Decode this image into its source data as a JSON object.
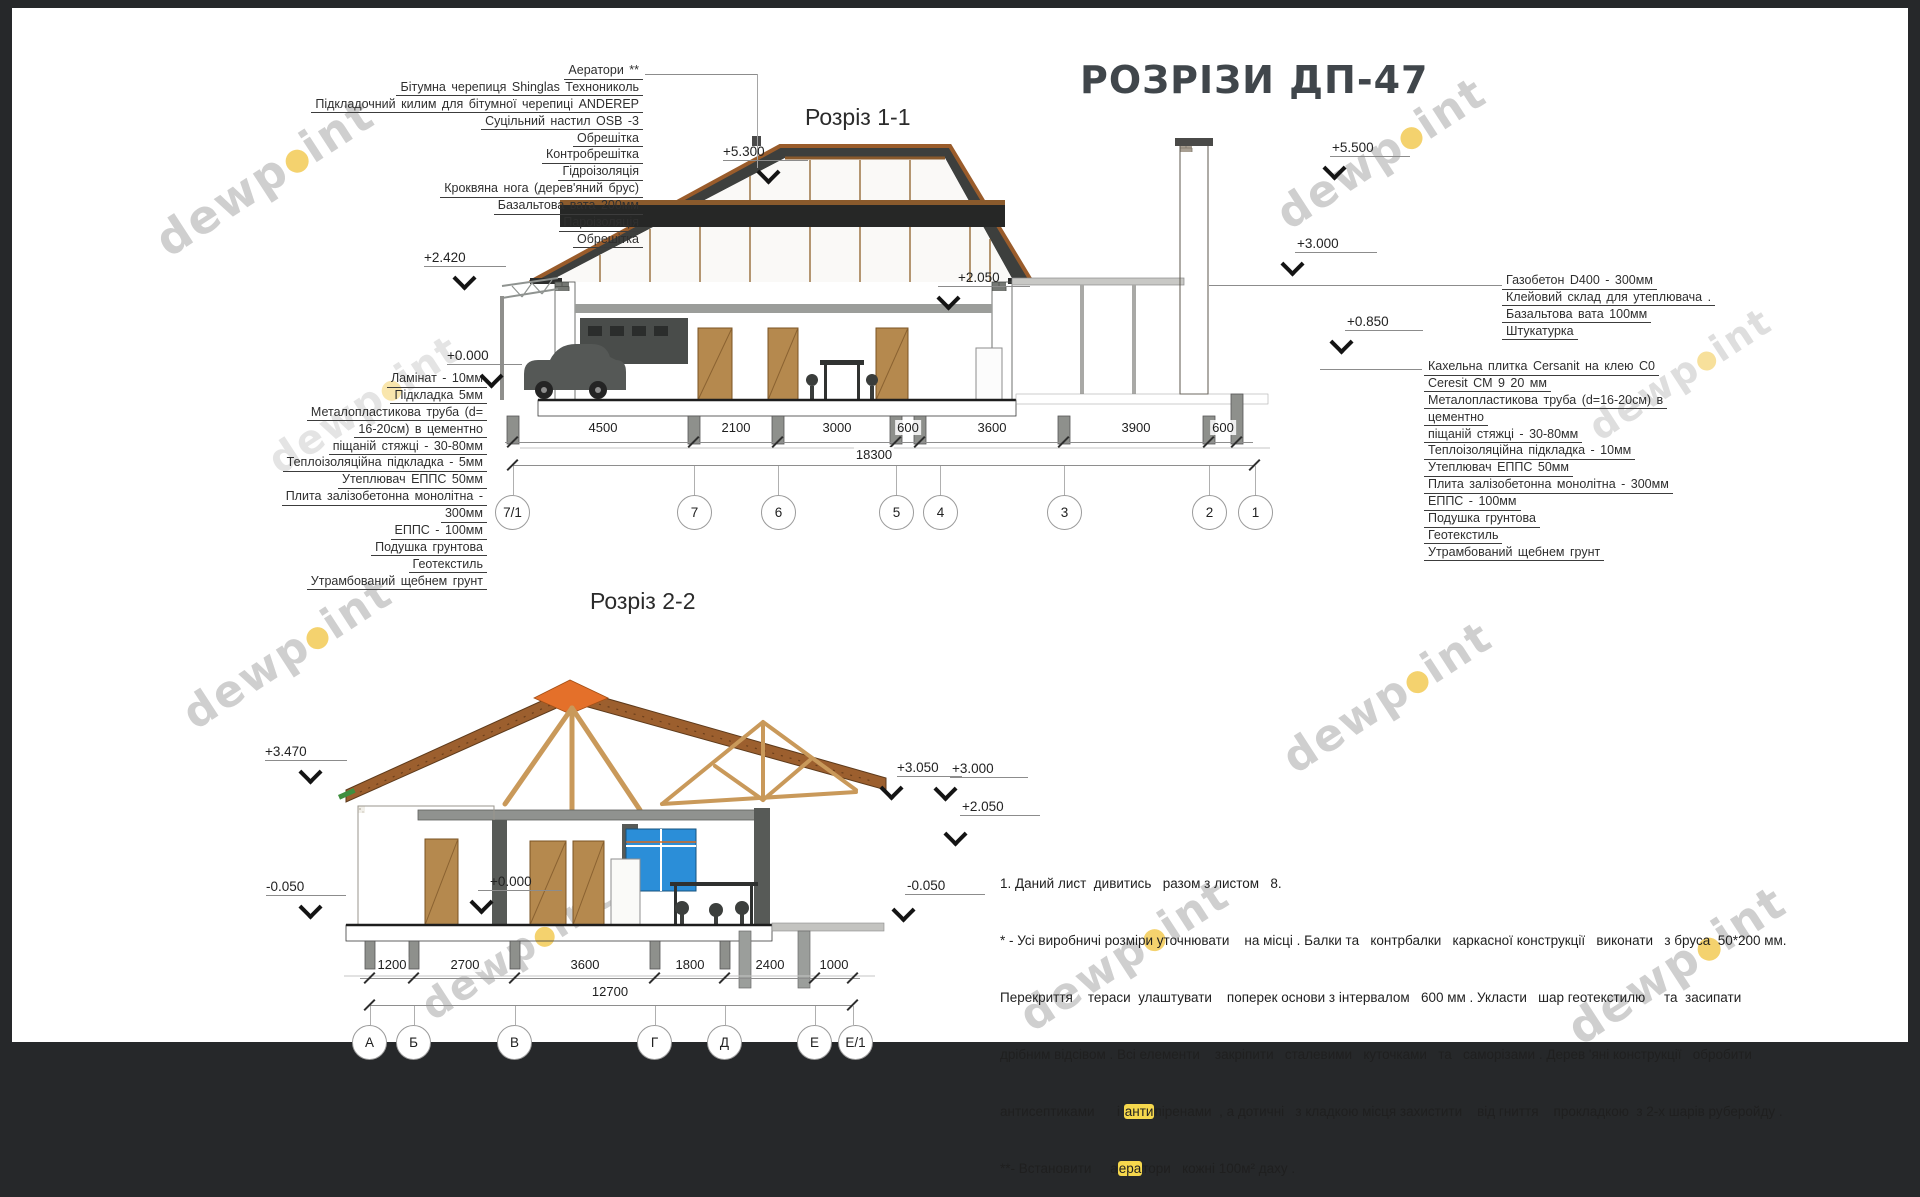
{
  "title": "РОЗРІЗИ ДП-47",
  "watermark": {
    "pre": "dewp",
    "post": "int"
  },
  "section1": {
    "heading": "Розріз 1-1",
    "roof_callouts": [
      "Аератори **",
      "Бітумна черепиця Shinglas Технониколь",
      "Підкладочний килим для бітумної черепиці ANDEREP",
      "Суцільний настил OSB -3",
      "Обрешітка",
      "Контробрешітка",
      "Гідроізоляція",
      "Кроквяна нога (дерев'яний брус)",
      "Базальтова вата 200мм",
      "Пароізоляція",
      "Обрешітка"
    ],
    "floor_callouts": [
      "Ламінат - 10мм",
      "Підкладка 5мм",
      "Металопластикова труба (d=",
      "16-20см) в цементно",
      "піщаній стяжці - 30-80мм",
      "Теплоізоляційна підкладка - 5мм",
      "Утеплювач ЕППС 50мм",
      "Плита залізобетонна монолітна -",
      "300мм",
      "ЕППС - 100мм",
      "Подушка грунтова",
      "Геотекстиль",
      "Утрамбований щебнем грунт"
    ],
    "wall_callouts": [
      "Газобетон D400 - 300мм",
      "Клейовий склад для утеплювача .",
      "Базальтова вата 100мм",
      "Штукатурка"
    ],
    "tile_callouts": [
      "Кахельна плитка Cersanit на клею C0",
      "Ceresit CM 9 20  мм",
      "Металопластикова труба (d=16-20см) в",
      "цементно",
      "піщаній стяжці - 30-80мм",
      "Теплоізоляційна підкладка - 10мм",
      "Утеплювач ЕППС 50мм",
      "Плита залізобетонна монолітна - 300мм",
      "ЕППС - 100мм",
      "Подушка грунтова",
      "Геотекстиль",
      "Утрамбований щебнем грунт"
    ],
    "elev": {
      "a": "+5.300",
      "b": "+2.420",
      "c": "+0.000",
      "d": "+5.500",
      "e": "+3.000",
      "f": "+0.850",
      "g": "+2.050"
    },
    "dims": [
      "4500",
      "2100",
      "3000",
      "600",
      "3600",
      "3900",
      "600"
    ],
    "total": "18300",
    "axes": [
      "7/1",
      "7",
      "6",
      "5",
      "4",
      "3",
      "2",
      "1"
    ]
  },
  "section2": {
    "heading": "Розріз 2-2",
    "elev": {
      "a": "+3.470",
      "b": "-0.050",
      "c": "+0.000",
      "d": "+3.050",
      "e": "+3.000",
      "f": "+2.050",
      "g": "-0.050"
    },
    "dims": [
      "1200",
      "2700",
      "3600",
      "1800",
      "2400",
      "1000"
    ],
    "total": "12700",
    "axes": [
      "А",
      "Б",
      "В",
      "Г",
      "Д",
      "Е",
      "Е/1"
    ]
  },
  "notes": {
    "l1": "1. Даний лист  дивитись   разом з листом   8.",
    "l2": "* - Усі виробничі розміри уточнювати    на місці . Балки та   контрбалки   каркасної конструкції   виконати   з бруса  50*200 мм.",
    "l3": "Перекриття    тераси  улаштувати    поперек основи з інтервалом   600 мм . Укласти   шар геотекстилю     та  засипати",
    "l4": "дрібним відсівом . Всі елементи    закріпити   сталевими   куточками   та   саморізами . Дерев 'яні конструкції   обробити",
    "l5_pre": "антисептиками      і ",
    "l5_hl": "анти",
    "l5_post": "піренами  , а дотичні   з кладкою місця захистити    від гниття    прокладкою  з 2-х шарів руберойду .",
    "l6_pre": "**- Встановити     а",
    "l6_hl": "ера",
    "l6_post": "тори   кожні 100м² даху ."
  }
}
